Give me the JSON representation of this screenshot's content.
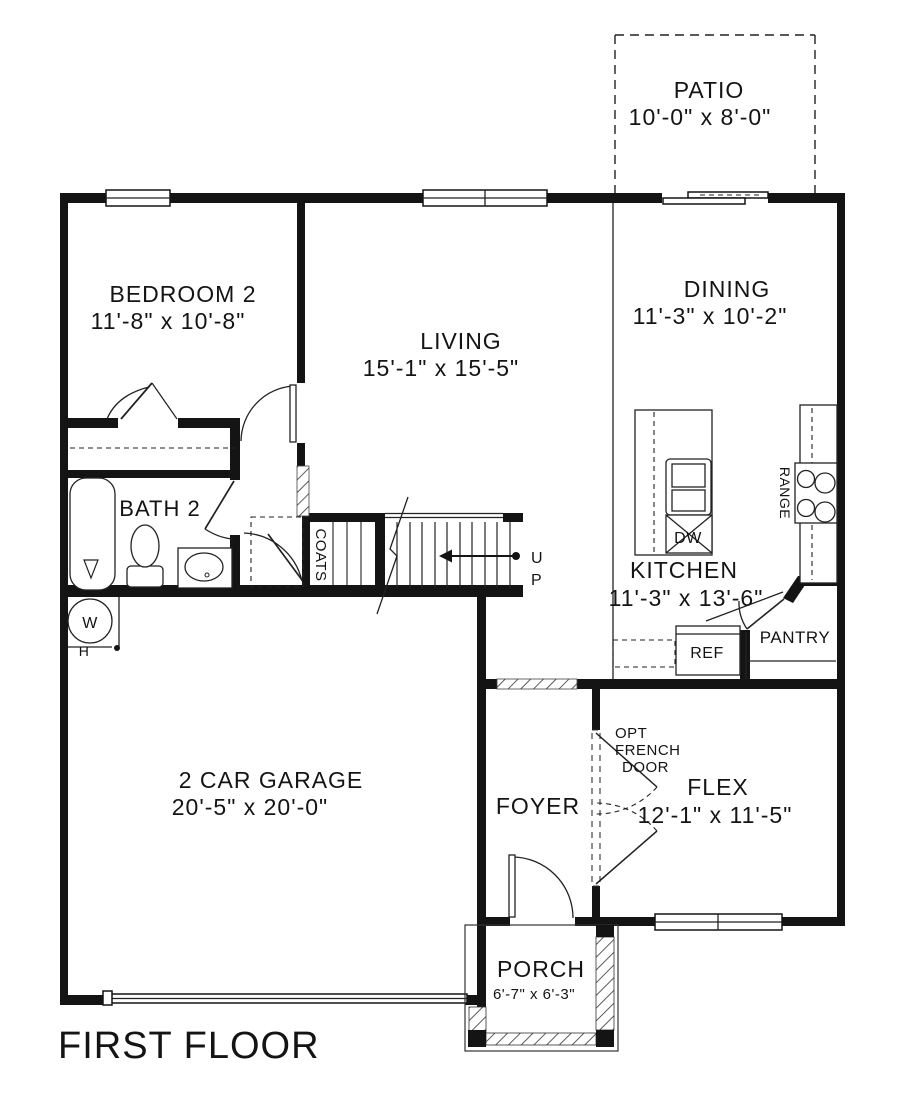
{
  "drawing_title": "FIRST FLOOR",
  "colors": {
    "line": "#141414",
    "background": "#ffffff"
  },
  "rooms": {
    "patio": {
      "name": "PATIO",
      "dims": "10'-0\" x 8'-0\""
    },
    "bedroom2": {
      "name": "BEDROOM 2",
      "dims": "11'-8\" x 10'-8\""
    },
    "living": {
      "name": "LIVING",
      "dims": "15'-1\" x 15'-5\""
    },
    "dining": {
      "name": "DINING",
      "dims": "11'-3\" x 10'-2\""
    },
    "bath2": {
      "name": "BATH 2"
    },
    "kitchen": {
      "name": "KITCHEN",
      "dims": "11'-3\" x 13'-6\""
    },
    "garage": {
      "name": "2 CAR GARAGE",
      "dims": "20'-5\" x  20'-0\""
    },
    "foyer": {
      "name": "FOYER"
    },
    "flex": {
      "name": "FLEX",
      "dims": "12'-1\" x 11'-5\""
    },
    "porch": {
      "name": "PORCH",
      "dims": "6'-7\" x  6'-3\""
    },
    "pantry": {
      "name": "PANTRY"
    },
    "coats_closet": {
      "name": "COATS"
    }
  },
  "fixtures": {
    "range": "RANGE",
    "dishwasher": "DW",
    "refrigerator": "REF",
    "water_heater_letter": "W",
    "water_heater_sub": "H"
  },
  "stairs": {
    "up_line1": "U",
    "up_line2": "P"
  },
  "annotations": {
    "opt_french_door_line1": "OPT",
    "opt_french_door_line2": "FRENCH",
    "opt_french_door_line3": "DOOR"
  }
}
